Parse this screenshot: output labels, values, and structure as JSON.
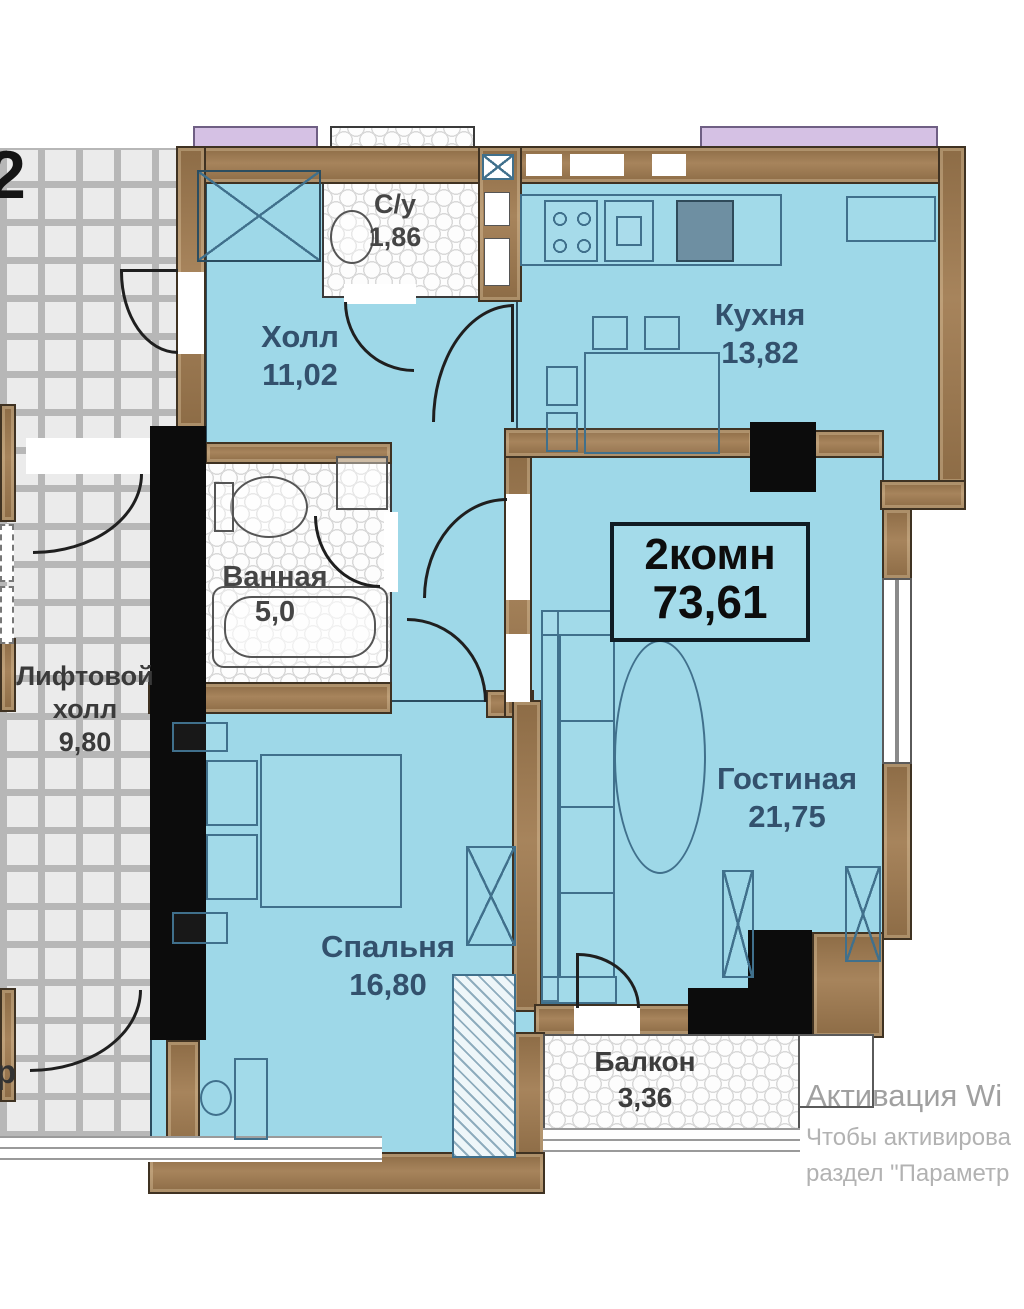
{
  "plan": {
    "badge": {
      "line1": "2комн",
      "line2": "73,61"
    },
    "rooms": {
      "wc": {
        "name": "С/у",
        "area": "1,86"
      },
      "hall": {
        "name": "Холл",
        "area": "11,02"
      },
      "kitchen": {
        "name": "Кухня",
        "area": "13,82"
      },
      "bathroom": {
        "name": "Ванная",
        "area": "5,0"
      },
      "elevator_hall": {
        "name_line1": "Лифтовой",
        "name_line2": "холл",
        "area": "9,80"
      },
      "living": {
        "name": "Гостиная",
        "area": "21,75"
      },
      "bedroom": {
        "name": "Спальня",
        "area": "16,80"
      },
      "balcony": {
        "name": "Балкон",
        "area": "3,36"
      }
    },
    "annotations": {
      "floor_number": "2",
      "corridor_partial_text": "р"
    },
    "watermark": {
      "line1": "Активация Wi",
      "line2": "Чтобы активирова",
      "line3": "раздел \"Параметр"
    },
    "colors": {
      "room_fill": "#9ed8e8",
      "wall_brown": "#97764e",
      "wall_black": "#0c0c0c",
      "lavender": "#d5c1e4",
      "label_blue": "#33516d",
      "label_gray": "#454545",
      "watermark_gray": "#a8a8a8"
    }
  }
}
